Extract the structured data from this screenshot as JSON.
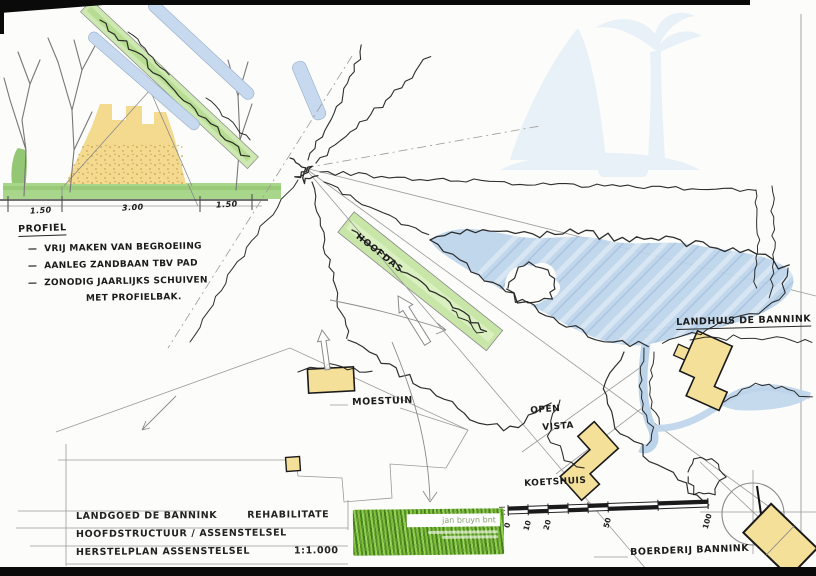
{
  "profile": {
    "heading": "PROFIEL",
    "notes": [
      "—  VRIJ MAKEN VAN BEGROEIING",
      "—  AANLEG ZANDBAAN TBV PAD",
      "—  ZONODIG JAARLIJKS SCHUIVEN",
      "MET PROFIELBAK."
    ],
    "dimensions": [
      "1.50",
      "3.00",
      "1.50"
    ]
  },
  "plan_labels": {
    "hoofdas": "HOOFDAS",
    "landhuis": "LANDHUIS DE BANNINK",
    "moestuin": "MOESTUIN",
    "open": "OPEN",
    "vista": "VISTA",
    "koetshuis": "KOETSHUIS",
    "boerderij": "BOERDERIJ BANNINK"
  },
  "title_block": {
    "line1_left": "LANDGOED DE BANNINK",
    "line1_right": "REHABILITATE",
    "line2": "HOOFDSTRUCTUUR / ASSENSTELSEL",
    "line3_left": "HERSTELPLAN ASSENSTELSEL",
    "scale": "1:1.000"
  },
  "scale_bar": {
    "ticks": [
      "0",
      "10",
      "20",
      "50",
      "100"
    ]
  },
  "logo": {
    "name": "jan bruyn bnt"
  },
  "colors": {
    "avenue_green": "#cde8b0",
    "water_blue": "#bcd4ea",
    "building_yellow": "#f5e09a",
    "ground_green": "#a8d68a",
    "sand_yellow": "#f3da8f"
  }
}
